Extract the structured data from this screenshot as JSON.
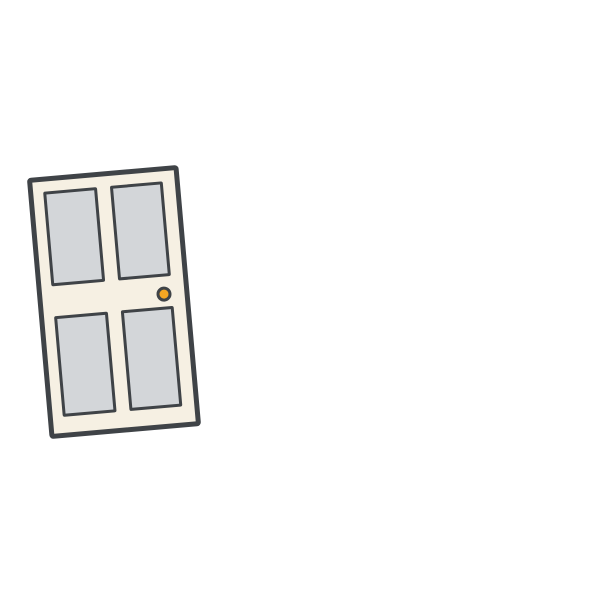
{
  "scene": {
    "description": "Flat illustration of a slightly tilted closed door with four grey window panels and a round orange knob on a plain white background",
    "colors": {
      "background": "#FFFFFF",
      "outline": "#3F4347",
      "frame": "#F6F0E3",
      "panel": "#D3D6D9",
      "knob": "#F5A623"
    },
    "door": {
      "label": "door",
      "rotation_deg": -5,
      "panel_count": 4,
      "panels": [
        "top-left",
        "top-right",
        "bottom-left",
        "bottom-right"
      ],
      "knob_side": "right"
    }
  }
}
